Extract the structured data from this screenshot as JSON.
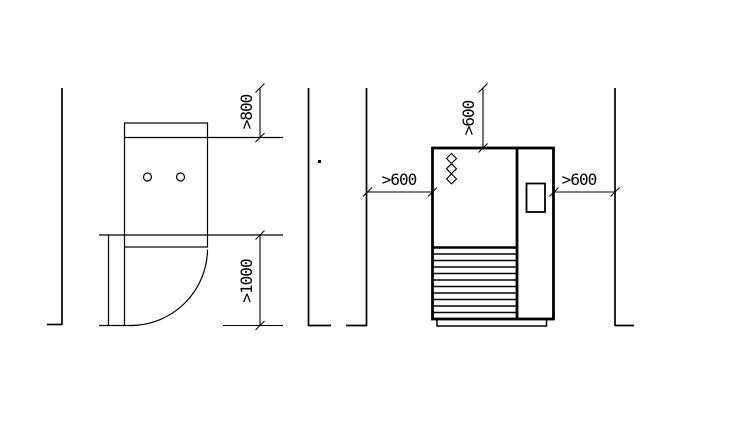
{
  "colors": {
    "background": "#ffffff",
    "line": "#000000"
  },
  "plan_view": {
    "rear_clearance_label": ">800",
    "front_clearance_label": ">1000"
  },
  "front_view": {
    "top_clearance_label": ">600",
    "left_clearance_label": ">600",
    "right_clearance_label": ">600"
  }
}
